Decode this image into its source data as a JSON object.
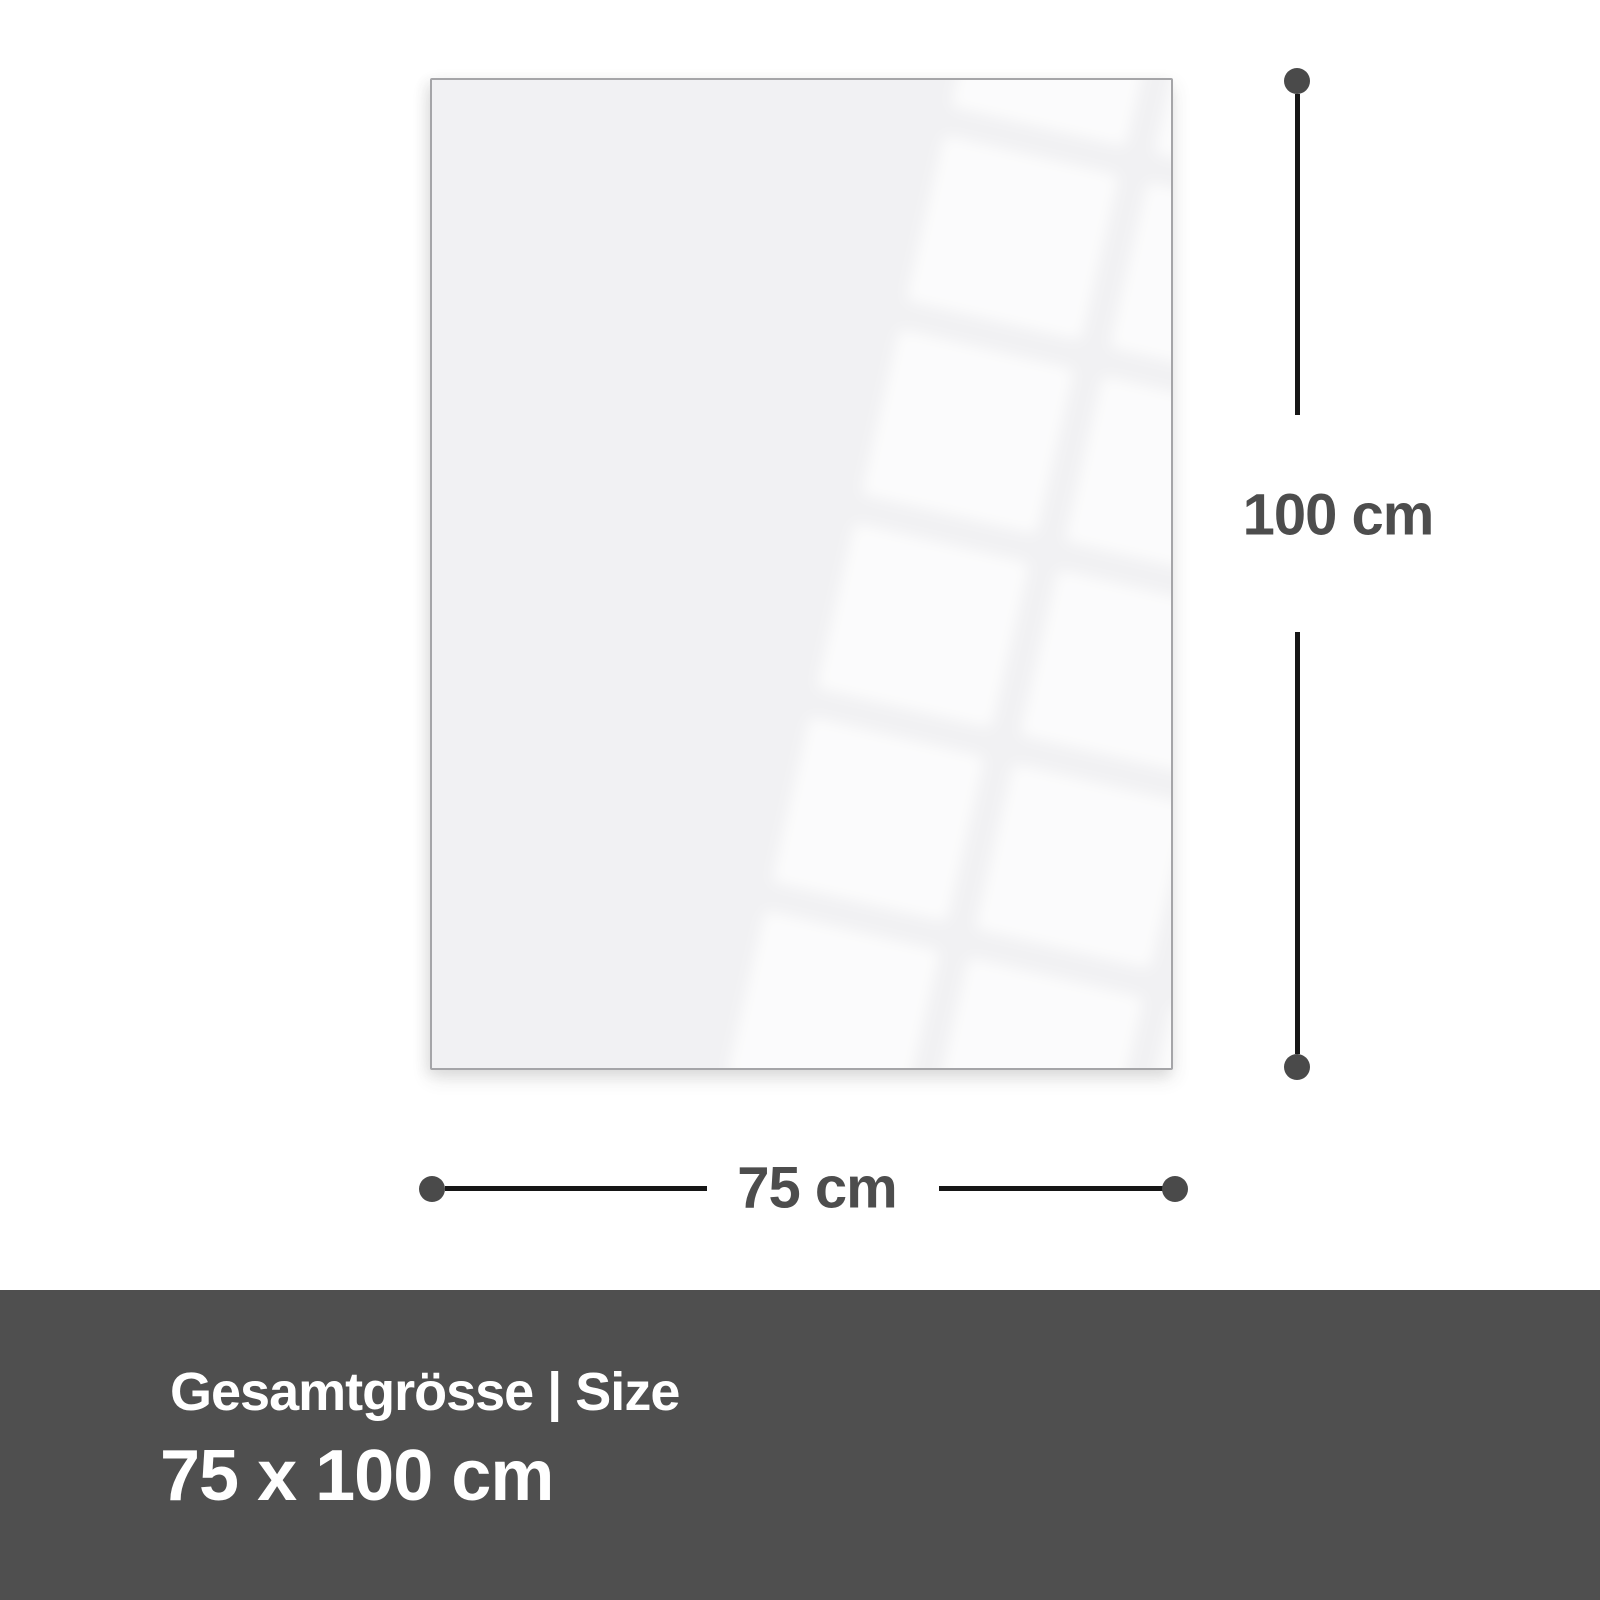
{
  "diagram": {
    "height_label": "100 cm",
    "width_label": "75 cm"
  },
  "banner": {
    "title": "Gesamtgrösse | Size",
    "size_value": "75 x 100 cm"
  },
  "colors": {
    "background": "#ffffff",
    "panel_fill": "#f1f1f3",
    "panel_border": "#a5a5a8",
    "dimension_line": "#161616",
    "dimension_dot": "#4a4a4a",
    "dimension_text": "#4d4d4d",
    "banner_background": "#4f4f4f",
    "banner_text": "#ffffff"
  }
}
